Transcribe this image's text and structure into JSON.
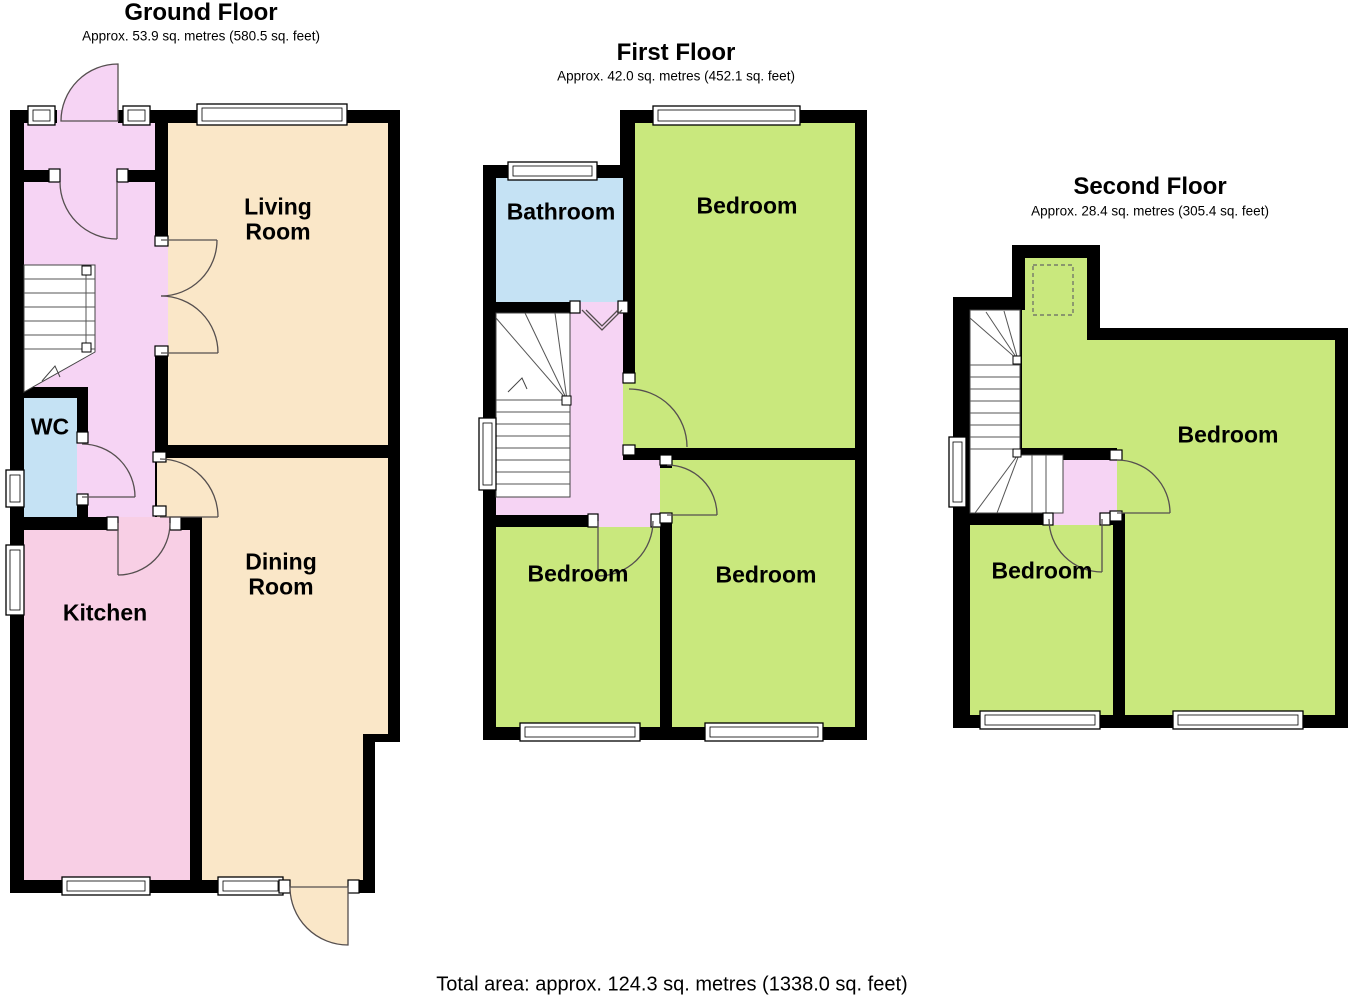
{
  "floors": [
    {
      "title": "Ground Floor",
      "subtitle": "Approx. 53.9 sq. metres (580.5 sq. feet)",
      "rooms": [
        {
          "label": "Living\nRoom"
        },
        {
          "label": "WC"
        },
        {
          "label": "Kitchen"
        },
        {
          "label": "Dining\nRoom"
        }
      ]
    },
    {
      "title": "First Floor",
      "subtitle": "Approx. 42.0 sq. metres (452.1 sq. feet)",
      "rooms": [
        {
          "label": "Bathroom"
        },
        {
          "label": "Bedroom"
        },
        {
          "label": "Bedroom"
        },
        {
          "label": "Bedroom"
        }
      ]
    },
    {
      "title": "Second Floor",
      "subtitle": "Approx. 28.4 sq. metres (305.4 sq. feet)",
      "rooms": [
        {
          "label": "Bedroom"
        },
        {
          "label": "Bedroom"
        }
      ]
    }
  ],
  "footer": {
    "total_area": "Total area: approx. 124.3 sq. metres (1338.0 sq. feet)"
  },
  "palette": {
    "wall": "#000000",
    "hall_landing": "#F6D4F4",
    "kitchen": "#F8CFE5",
    "living_dining": "#FAE7C8",
    "bath_wc": "#C5E2F4",
    "bedroom": "#C9E87D"
  }
}
